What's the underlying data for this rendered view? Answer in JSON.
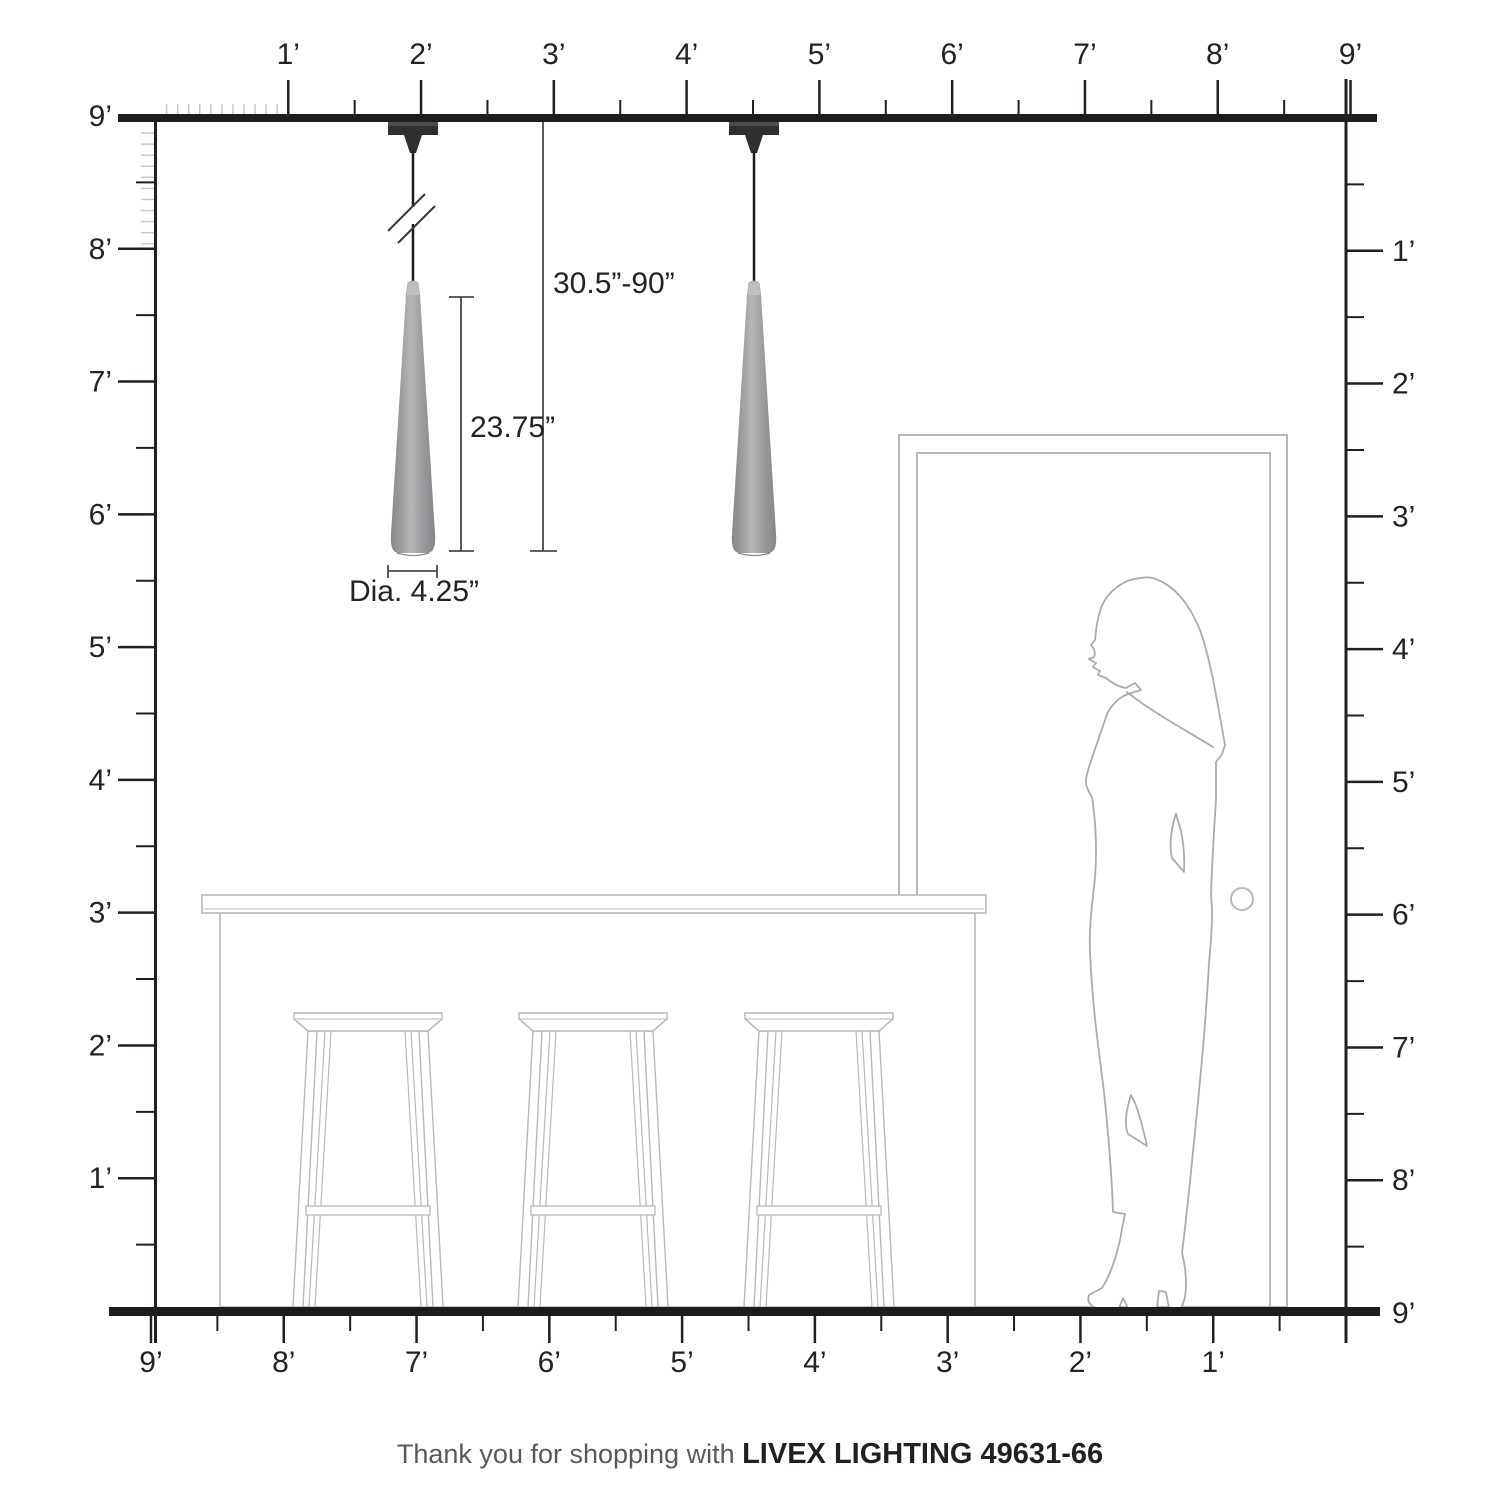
{
  "title": "Livex Lighting pendant scale diagram",
  "rulers": {
    "top": [
      "1’",
      "2’",
      "3’",
      "4’",
      "5’",
      "6’",
      "7’",
      "8’",
      "9’"
    ],
    "bottom": [
      "9’",
      "8’",
      "7’",
      "6’",
      "5’",
      "4’",
      "3’",
      "2’",
      "1’"
    ],
    "left": [
      "9’",
      "8’",
      "7’",
      "6’",
      "5’",
      "4’",
      "3’",
      "2’",
      "1’"
    ],
    "right": [
      "1’",
      "2’",
      "3’",
      "4’",
      "5’",
      "6’",
      "7’",
      "8’",
      "9’"
    ]
  },
  "dimensions": {
    "hang_range": "30.5”-90”",
    "fixture_height": "23.75”",
    "diameter": "Dia. 4.25”"
  },
  "footer": {
    "prefix": "Thank you for shopping with ",
    "brand": "LIVEX LIGHTING 49631-66"
  },
  "colors": {
    "structure": "#231f20",
    "slab": "#1d1d1f",
    "dim_line": "#4a4a4c",
    "furniture": "#b8b8ba",
    "figure": "#ababad",
    "inch_tick": "#c9c9ca",
    "cone_gray": "#9b9b9e",
    "mount_dark": "#2f2f31"
  }
}
